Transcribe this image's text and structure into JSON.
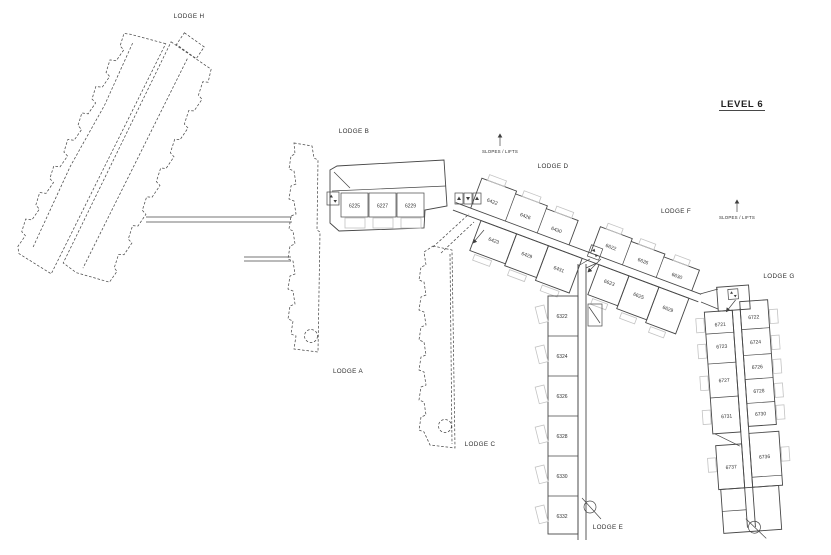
{
  "title": "LEVEL 6",
  "annotations": {
    "slopes_lifts": "SLOPES / LIFTS"
  },
  "lodges": {
    "h": {
      "name": "LODGE H"
    },
    "a": {
      "name": "LODGE A"
    },
    "b": {
      "name": "LODGE B",
      "rooms": [
        "6225",
        "6227",
        "6229"
      ]
    },
    "c": {
      "name": "LODGE C"
    },
    "d": {
      "name": "LODGE D",
      "rooms_north": [
        "6422",
        "6426",
        "6430"
      ],
      "rooms_south": [
        "6423",
        "6429",
        "6431"
      ]
    },
    "e": {
      "name": "LODGE E",
      "rooms": [
        "6322",
        "6324",
        "6326",
        "6328",
        "6330",
        "6332"
      ]
    },
    "f": {
      "name": "LODGE F",
      "rooms_north": [
        "6622",
        "6626",
        "6630"
      ],
      "rooms_south": [
        "6623",
        "6625",
        "6629"
      ]
    },
    "g": {
      "name": "LODGE G",
      "rooms_west": [
        "6721",
        "6723",
        "6727",
        "6731",
        "6737"
      ],
      "rooms_east": [
        "6722",
        "6724",
        "6726",
        "6728",
        "6730",
        "6736"
      ]
    }
  },
  "icons": {
    "lift": "lift-box",
    "lift_bank": "triple-lift-box",
    "slope_arrow": "up-arrow",
    "direction_arrow": "diagonal-arrow",
    "stair_exit": "circle-slash"
  },
  "colors": {
    "line": "#474747",
    "light": "#c3c3c3",
    "text": "#2e2e2e",
    "background": "#ffffff"
  }
}
